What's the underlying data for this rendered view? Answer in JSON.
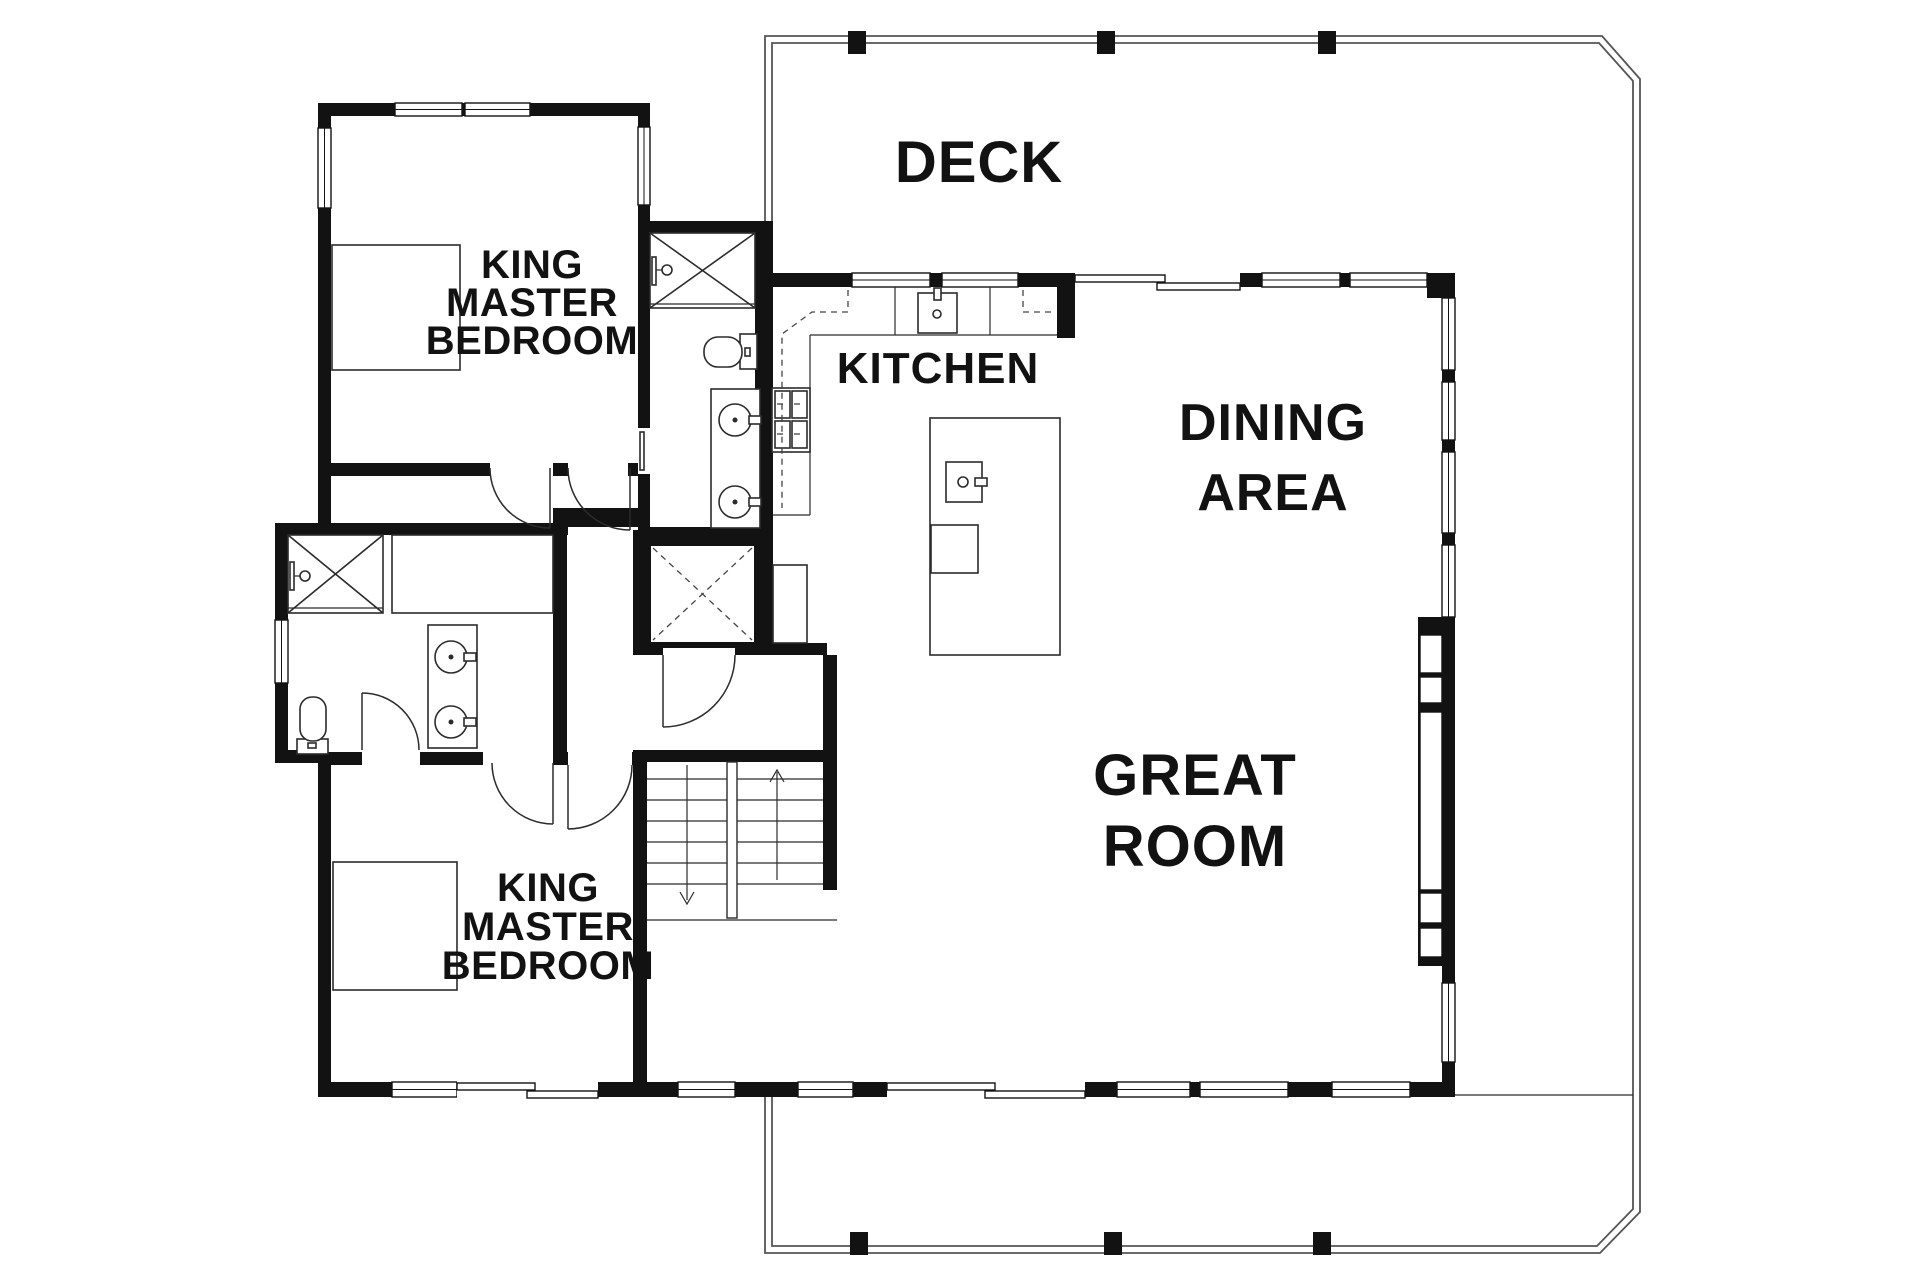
{
  "rooms": {
    "deck": {
      "label": "DECK"
    },
    "kitchen": {
      "label": "KITCHEN"
    },
    "dining": {
      "lines": [
        "DINING",
        "AREA"
      ]
    },
    "great_room": {
      "lines": [
        "GREAT",
        "ROOM"
      ]
    },
    "master_top": {
      "lines": [
        "KING",
        "MASTER",
        "BEDROOM"
      ]
    },
    "master_bottom": {
      "lines": [
        "KING",
        "MASTER",
        "BEDROOM"
      ]
    }
  },
  "colors": {
    "wall": "#121212",
    "background": "#ffffff",
    "deck_line": "#555555"
  }
}
